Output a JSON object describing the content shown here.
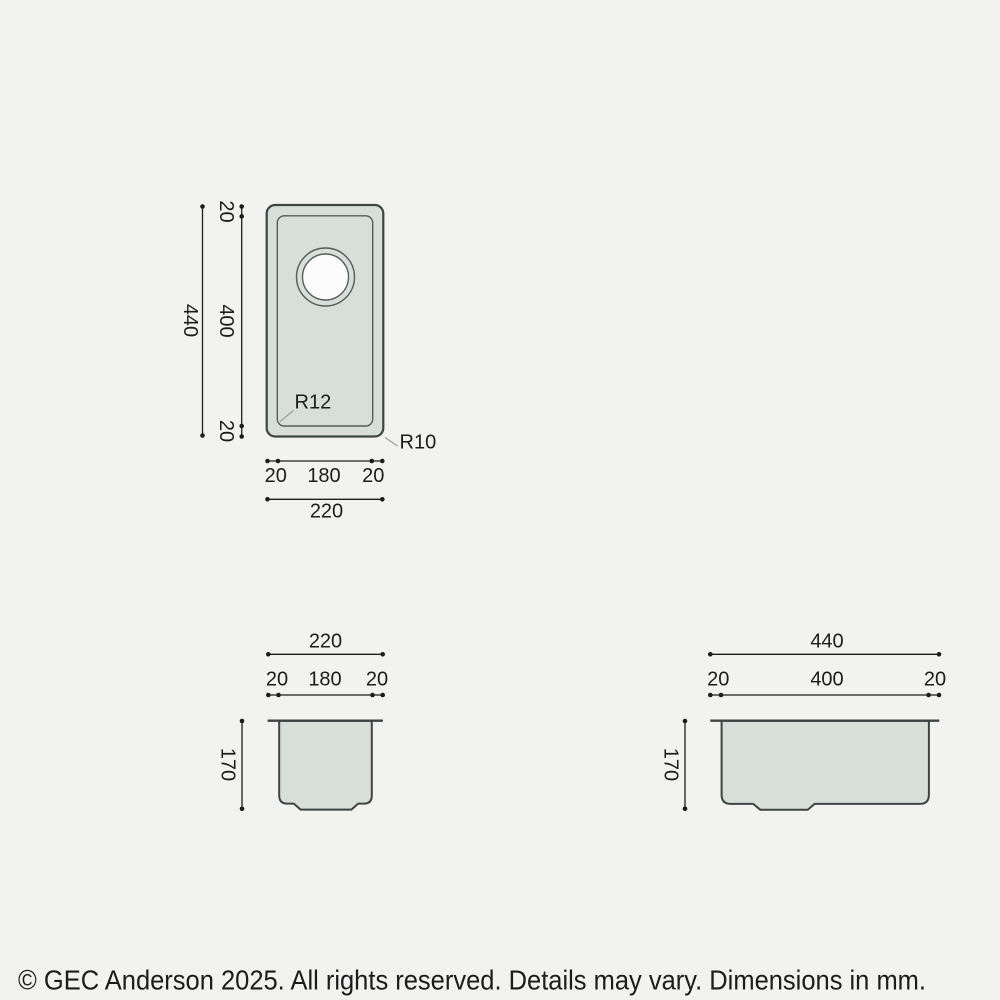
{
  "drawing": {
    "plan": {
      "height_total": "440",
      "height_segments": [
        "20",
        "400",
        "20"
      ],
      "width_segments": [
        "20",
        "180",
        "20"
      ],
      "width_total": "220",
      "inner_radius_label": "R12",
      "outer_radius_label": "R10"
    },
    "front": {
      "width_total": "220",
      "width_segments": [
        "20",
        "180",
        "20"
      ],
      "depth_total": "170"
    },
    "side": {
      "width_total": "440",
      "width_segments": [
        "20",
        "400",
        "20"
      ],
      "depth_total": "170"
    }
  },
  "footer": {
    "copyright": "© GEC Anderson 2025. All rights reserved. Details may vary. Dimensions in mm."
  },
  "colors": {
    "background": "#f2f2f0",
    "sink_fill": "#d8ded9",
    "sink_outline": "#3e4444",
    "sink_outline_light": "#565c5a",
    "dimension": "#1b1c1c",
    "leader": "#989d9c",
    "drain_fill": "#fbfcfb"
  }
}
